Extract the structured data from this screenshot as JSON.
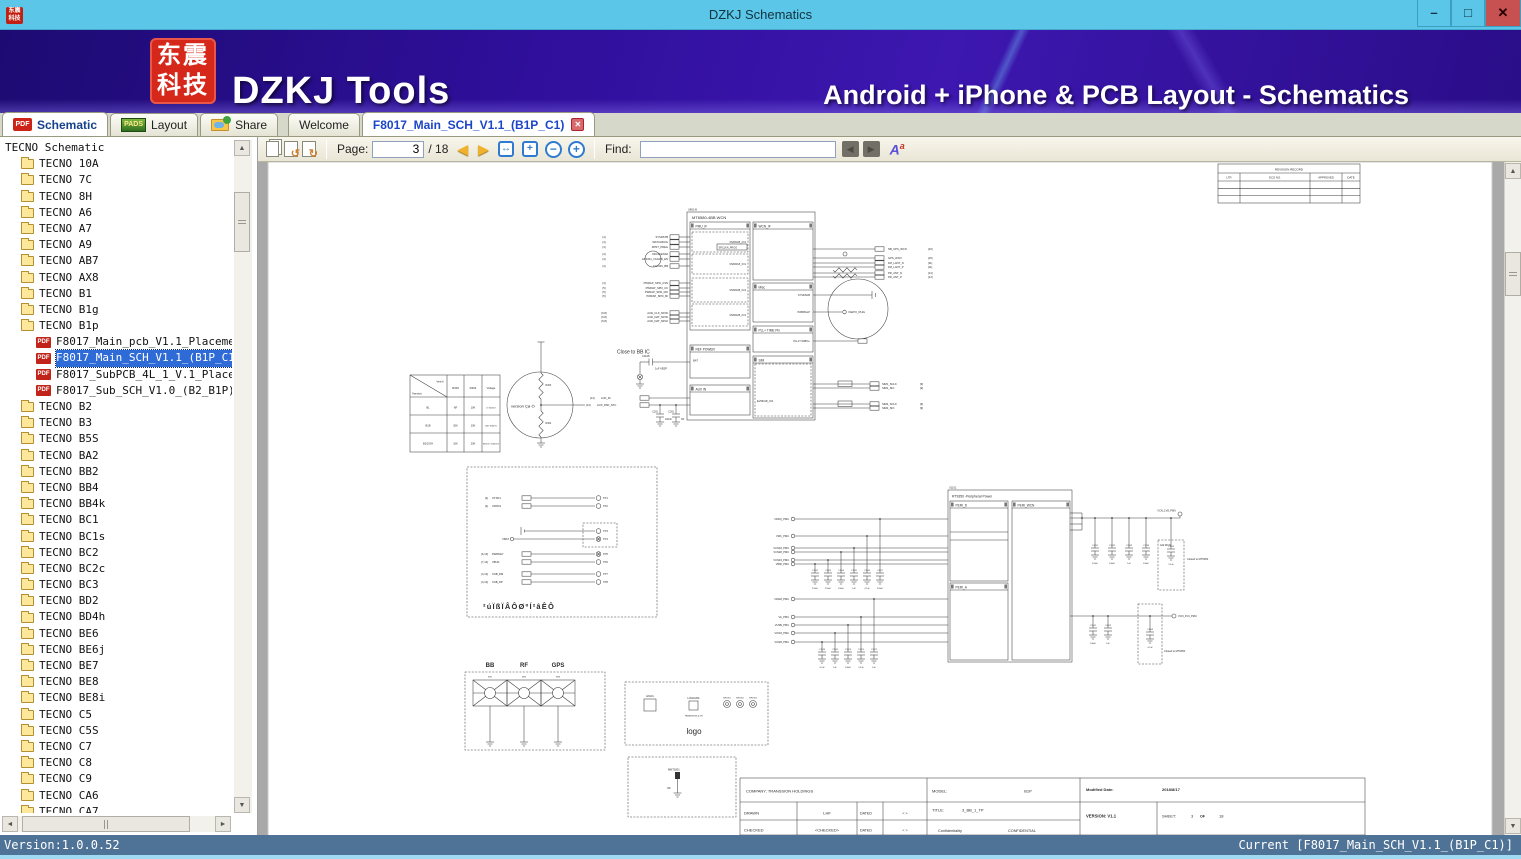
{
  "window": {
    "title": "DZKJ Schematics"
  },
  "icons": {
    "pdf": "PDF",
    "pads": "PADS",
    "close_tab": "✕",
    "minimize": "–",
    "maximize": "□",
    "close": "✕",
    "arrow_up": "▲",
    "arrow_down": "▼",
    "arrow_left": "◄",
    "arrow_right": "►",
    "prev_page": "◀",
    "next_page": "▶",
    "rotate_left": "↺",
    "rotate_right": "↻",
    "fit_width": "↔",
    "fit_page": "+",
    "zoom_out": "−",
    "zoom_in": "+",
    "find_prev": "◀",
    "find_next": "▶",
    "font_a": "A",
    "font_a_sup": "a"
  },
  "banner": {
    "logo_text": "东震科技",
    "app_name": "DZKJ Tools",
    "tagline": "Android + iPhone & PCB Layout - Schematics"
  },
  "tabs": {
    "left": [
      {
        "label": "Schematic"
      },
      {
        "label": "Layout"
      },
      {
        "label": "Share"
      }
    ],
    "docs": [
      {
        "label": "Welcome"
      },
      {
        "label": "F8017_Main_SCH_V1.1_(B1P_C1)"
      }
    ]
  },
  "toolbar": {
    "page_label": "Page:",
    "page_value": "3",
    "page_total": "/ 18",
    "find_label": "Find:",
    "find_value": ""
  },
  "sidebar": {
    "root": "TECNO Schematic",
    "items": [
      {
        "label": "TECNO 10A",
        "type": "folder"
      },
      {
        "label": "TECNO 7C",
        "type": "folder"
      },
      {
        "label": "TECNO 8H",
        "type": "folder"
      },
      {
        "label": "TECNO A6",
        "type": "folder"
      },
      {
        "label": "TECNO A7",
        "type": "folder"
      },
      {
        "label": "TECNO A9",
        "type": "folder"
      },
      {
        "label": "TECNO AB7",
        "type": "folder"
      },
      {
        "label": "TECNO AX8",
        "type": "folder"
      },
      {
        "label": "TECNO B1",
        "type": "folder"
      },
      {
        "label": "TECNO B1g",
        "type": "folder"
      },
      {
        "label": "TECNO B1p",
        "type": "folder"
      },
      {
        "label": "F8017_Main_pcb_V1.1_Placement",
        "type": "pdf"
      },
      {
        "label": "F8017_Main_SCH_V1.1_(B1P_C1)",
        "type": "pdf",
        "selected": true
      },
      {
        "label": "F8017_SubPCB_4L_1_V.1_Placement",
        "type": "pdf"
      },
      {
        "label": "F8017_Sub_SCH_V1.0_(B2_B1P)",
        "type": "pdf"
      },
      {
        "label": "TECNO B2",
        "type": "folder"
      },
      {
        "label": "TECNO B3",
        "type": "folder"
      },
      {
        "label": "TECNO B5S",
        "type": "folder"
      },
      {
        "label": "TECNO BA2",
        "type": "folder"
      },
      {
        "label": "TECNO BB2",
        "type": "folder"
      },
      {
        "label": "TECNO BB4",
        "type": "folder"
      },
      {
        "label": "TECNO BB4k",
        "type": "folder"
      },
      {
        "label": "TECNO BC1",
        "type": "folder"
      },
      {
        "label": "TECNO BC1s",
        "type": "folder"
      },
      {
        "label": "TECNO BC2",
        "type": "folder"
      },
      {
        "label": "TECNO BC2c",
        "type": "folder"
      },
      {
        "label": "TECNO BC3",
        "type": "folder"
      },
      {
        "label": "TECNO BD2",
        "type": "folder"
      },
      {
        "label": "TECNO BD4h",
        "type": "folder"
      },
      {
        "label": "TECNO BE6",
        "type": "folder"
      },
      {
        "label": "TECNO BE6j",
        "type": "folder"
      },
      {
        "label": "TECNO BE7",
        "type": "folder"
      },
      {
        "label": "TECNO BE8",
        "type": "folder"
      },
      {
        "label": "TECNO BE8i",
        "type": "folder"
      },
      {
        "label": "TECNO C5",
        "type": "folder"
      },
      {
        "label": "TECNO C5S",
        "type": "folder"
      },
      {
        "label": "TECNO C7",
        "type": "folder"
      },
      {
        "label": "TECNO C8",
        "type": "folder"
      },
      {
        "label": "TECNO C9",
        "type": "folder"
      },
      {
        "label": "TECNO CA6",
        "type": "folder"
      },
      {
        "label": "TECNO CA7",
        "type": "folder"
      }
    ]
  },
  "statusbar": {
    "left": "Version:1.0.0.52",
    "right": "Current [F8017_Main_SCH_V1.1_(B1P_C1)]"
  },
  "schematic": {
    "revision_table": {
      "title": "REVISION RECORD",
      "headers": [
        "LTR",
        "ECO NO.",
        "APPROVED",
        "DATE"
      ]
    },
    "ic": {
      "ref": "U801-B",
      "name": "MT6580-4BB WCN",
      "sections": {
        "pmu": "PMU_IF",
        "ref_power": "REF POWER",
        "aux": "AUX IN",
        "wcn": "WCN_IF",
        "misc": "Misc",
        "pll": "PLL+ TIME Pin",
        "sim": "SIM"
      },
      "dvdd_labels": [
        "DVDD28_IO1",
        "DVDD18_IO1",
        "DVDD28_IO1",
        "DVDD28_IO1"
      ],
      "srclk_label": "SRCLKA_PROG",
      "evdd_label": "EVDD18_IO1",
      "bat_label": "BAT",
      "kepo": "KEPO_PHG",
      "pll_label": "PLL1T WRPLL",
      "misc_labels": [
        "SYSRSGB",
        "PWRBGLP"
      ],
      "left_pins": [
        {
          "ref": "[4]",
          "name": "SYSRSTB"
        },
        {
          "ref": "[4]",
          "name": "WATCHDOG"
        },
        {
          "ref": "[4]",
          "name": "KPNT_PREG"
        },
        {
          "ref": "[4]",
          "name": "SRCLKENA0"
        },
        {
          "ref": "[4]",
          "name": "GPIO04_VCAMD_EN"
        },
        {
          "ref": "[4]",
          "name": "CLK32K_BB"
        },
        {
          "ref": "[4]",
          "name": "PWRAP_SPI0_CSN"
        },
        {
          "ref": "[5]",
          "name": "PWRAP_SPI0_CK"
        },
        {
          "ref": "[5]",
          "name": "PWRAP_SPI0_MO"
        },
        {
          "ref": "[5]",
          "name": "PWRAP_SPI0_MI"
        },
        {
          "ref": "[6,8]",
          "name": "AUD_CLK_MOSI"
        },
        {
          "ref": "[6,8]",
          "name": "AUD_DAT_MOSI"
        },
        {
          "ref": "[6,8]",
          "name": "AUD_DAT_MISO"
        }
      ],
      "right_pins": [
        {
          "name": "NB_UPS_WCN",
          "ref": "[16]"
        },
        {
          "name": "GPS_WCN",
          "ref": "[15]"
        },
        {
          "name": "FM_LANT_N",
          "ref": "[11]"
        },
        {
          "name": "FM_LANT_P",
          "ref": "[11]"
        },
        {
          "name": "PR_ANT_N",
          "ref": "[14]"
        },
        {
          "name": "PR_ANT_P",
          "ref": "[14]"
        }
      ],
      "sim_pins": [
        {
          "name": "SIM1_SCLK",
          "ref": "[9]"
        },
        {
          "name": "SIM1_SIO",
          "ref": "[9]"
        },
        {
          "name": "SIM2_SCLK",
          "ref": "[9]"
        },
        {
          "name": "SIM2_SIO",
          "ref": "[9]"
        }
      ],
      "aux_pins": [
        {
          "ref": "[14]",
          "name": "LCD_ID"
        },
        {
          "ref": "[13]",
          "name": "AUX_PAD_NTC"
        }
      ],
      "ref_cap": {
        "ref": "C1108",
        "value": "1uF KEEP"
      },
      "aux_caps": [
        {
          "ref": "C201",
          "value": "100nF"
        },
        {
          "ref": "C301",
          "value": "NF"
        }
      ]
    },
    "close_note": "Close to BB IC",
    "version_table": {
      "diag_top": "°æ±¾",
      "diag_bottom": "Version",
      "headers": [
        "R303",
        "R304",
        "Voltage"
      ],
      "rows": [
        [
          "B1",
          "NF",
          "10K",
          "0~300mV"
        ],
        [
          "B1B",
          "20K",
          "10K",
          "300~900mV"
        ],
        [
          "B1/2/GH",
          "10K",
          "20K",
          "900mV~1800mV"
        ]
      ]
    },
    "version_circle": {
      "label": "version Çø·Ö",
      "r_top": "R303",
      "r_bot": "R304"
    },
    "testpoints": [
      {
        "ref": "[4]",
        "name": "UTXD1",
        "tp": "TP1"
      },
      {
        "ref": "[4]",
        "name": "URXD1",
        "tp": "TP2"
      },
      {
        "ref": "",
        "name": "",
        "tp": "TP3"
      },
      {
        "ref": "",
        "name": "VBAT",
        "tp": "TP4"
      },
      {
        "ref": "[6,13]",
        "name": "PWRKEY",
        "tp": "TP5"
      },
      {
        "ref": "[7,14]",
        "name": "VBUS",
        "tp": "TP6"
      },
      {
        "ref": "[4,14]",
        "name": "USB_DM",
        "tp": "TP7"
      },
      {
        "ref": "[4,14]",
        "name": "USB_DP",
        "tp": "TP8"
      }
    ],
    "tp_note": "²úÏßÏÂÔØºÍ²âÊÔ",
    "connectors": {
      "labels": [
        "BB",
        "RF",
        "GPS"
      ],
      "refs": [
        "SH1",
        "SH2",
        "SH3"
      ]
    },
    "logo_box": {
      "label": "logo",
      "en": "EN101",
      "logo_ref": "LOGO1801",
      "logo_sub": "TRANSSION-6.5H",
      "mp": [
        "MP1801",
        "MP1802",
        "MP1803"
      ]
    },
    "mmt_box": {
      "ref": "MMT1801",
      "value": "NF"
    },
    "rt9350": {
      "ref": "U1101",
      "name": "RT9350 -Peripheral Power",
      "sections": [
        "PERI_D",
        "PERI_WCN",
        "PERI_A"
      ],
      "left_nets": [
        "VDDQ_PMU",
        "VMC_PMU",
        "VCN18_PMU",
        "VCN28_PMU",
        "VCN33_PMU",
        "VIBR_PMU",
        "VRAM_PMU",
        "VA_PMU",
        "VUSB_PMU",
        "VIO18_PMU",
        "VIO28_PMU"
      ],
      "bank1": {
        "refs": [
          "C1112",
          "C1113",
          "C1114",
          "C1115",
          "C1116",
          "C1117"
        ],
        "values": [
          "220nF",
          "220nF",
          "100nF",
          "1uF",
          "4.7uF",
          "220nF"
        ]
      },
      "bank2": {
        "refs": [
          "C1118",
          "C1119",
          "C1120",
          "C1121",
          "C1122"
        ],
        "values": [
          "4.7uF",
          "1uF",
          "100nF",
          "2.2uF",
          "1uF"
        ]
      },
      "bank3": {
        "refs": [
          "C1131",
          "C1132",
          "C1133",
          "C1134"
        ],
        "values": [
          "220nF",
          "100nF",
          "1uF",
          "100nF"
        ]
      },
      "bank4": {
        "refs": [
          "C1141",
          "C1142"
        ],
        "values": [
          "100nF",
          "1uF"
        ]
      },
      "cap_top_dashed": {
        "ref": "C1135",
        "value": "2.2uF"
      },
      "cap_bottom_dashed": {
        "ref": "C1143",
        "value": "4.7uF"
      },
      "net_top": "VCN_1V8_PMU",
      "net_bottom": "VCN_3V3_PMU",
      "note_top": "Add WCN",
      "closed_top": "Closed to MT6350",
      "closed_bottom": "Closed to MT6350"
    },
    "title_block": {
      "company": "COMPANY: TRANSSION HOLDINGS",
      "model_label": "MODEL:",
      "model": "B1P",
      "mod_date_label": "Modified Date:",
      "mod_date": "2018/8/17",
      "drawn_label": "DRAWN",
      "drawn": "LHF",
      "dated1": "DATED",
      "arrows1": "<  >",
      "checked_label": "CHECKED",
      "checked": "<CHECKED>",
      "dated2": "DATED",
      "arrows2": "<  >",
      "title_label": "TITLE:",
      "title": "3_BB_1_TP",
      "conf_label": "Confidentiality",
      "conf": "CONFIDENTIAL",
      "version": "VERSION: V1.1",
      "sheet_label": "SHEET:",
      "sheet_num": "3",
      "sheet_of": "OF",
      "sheet_total": "18"
    }
  }
}
